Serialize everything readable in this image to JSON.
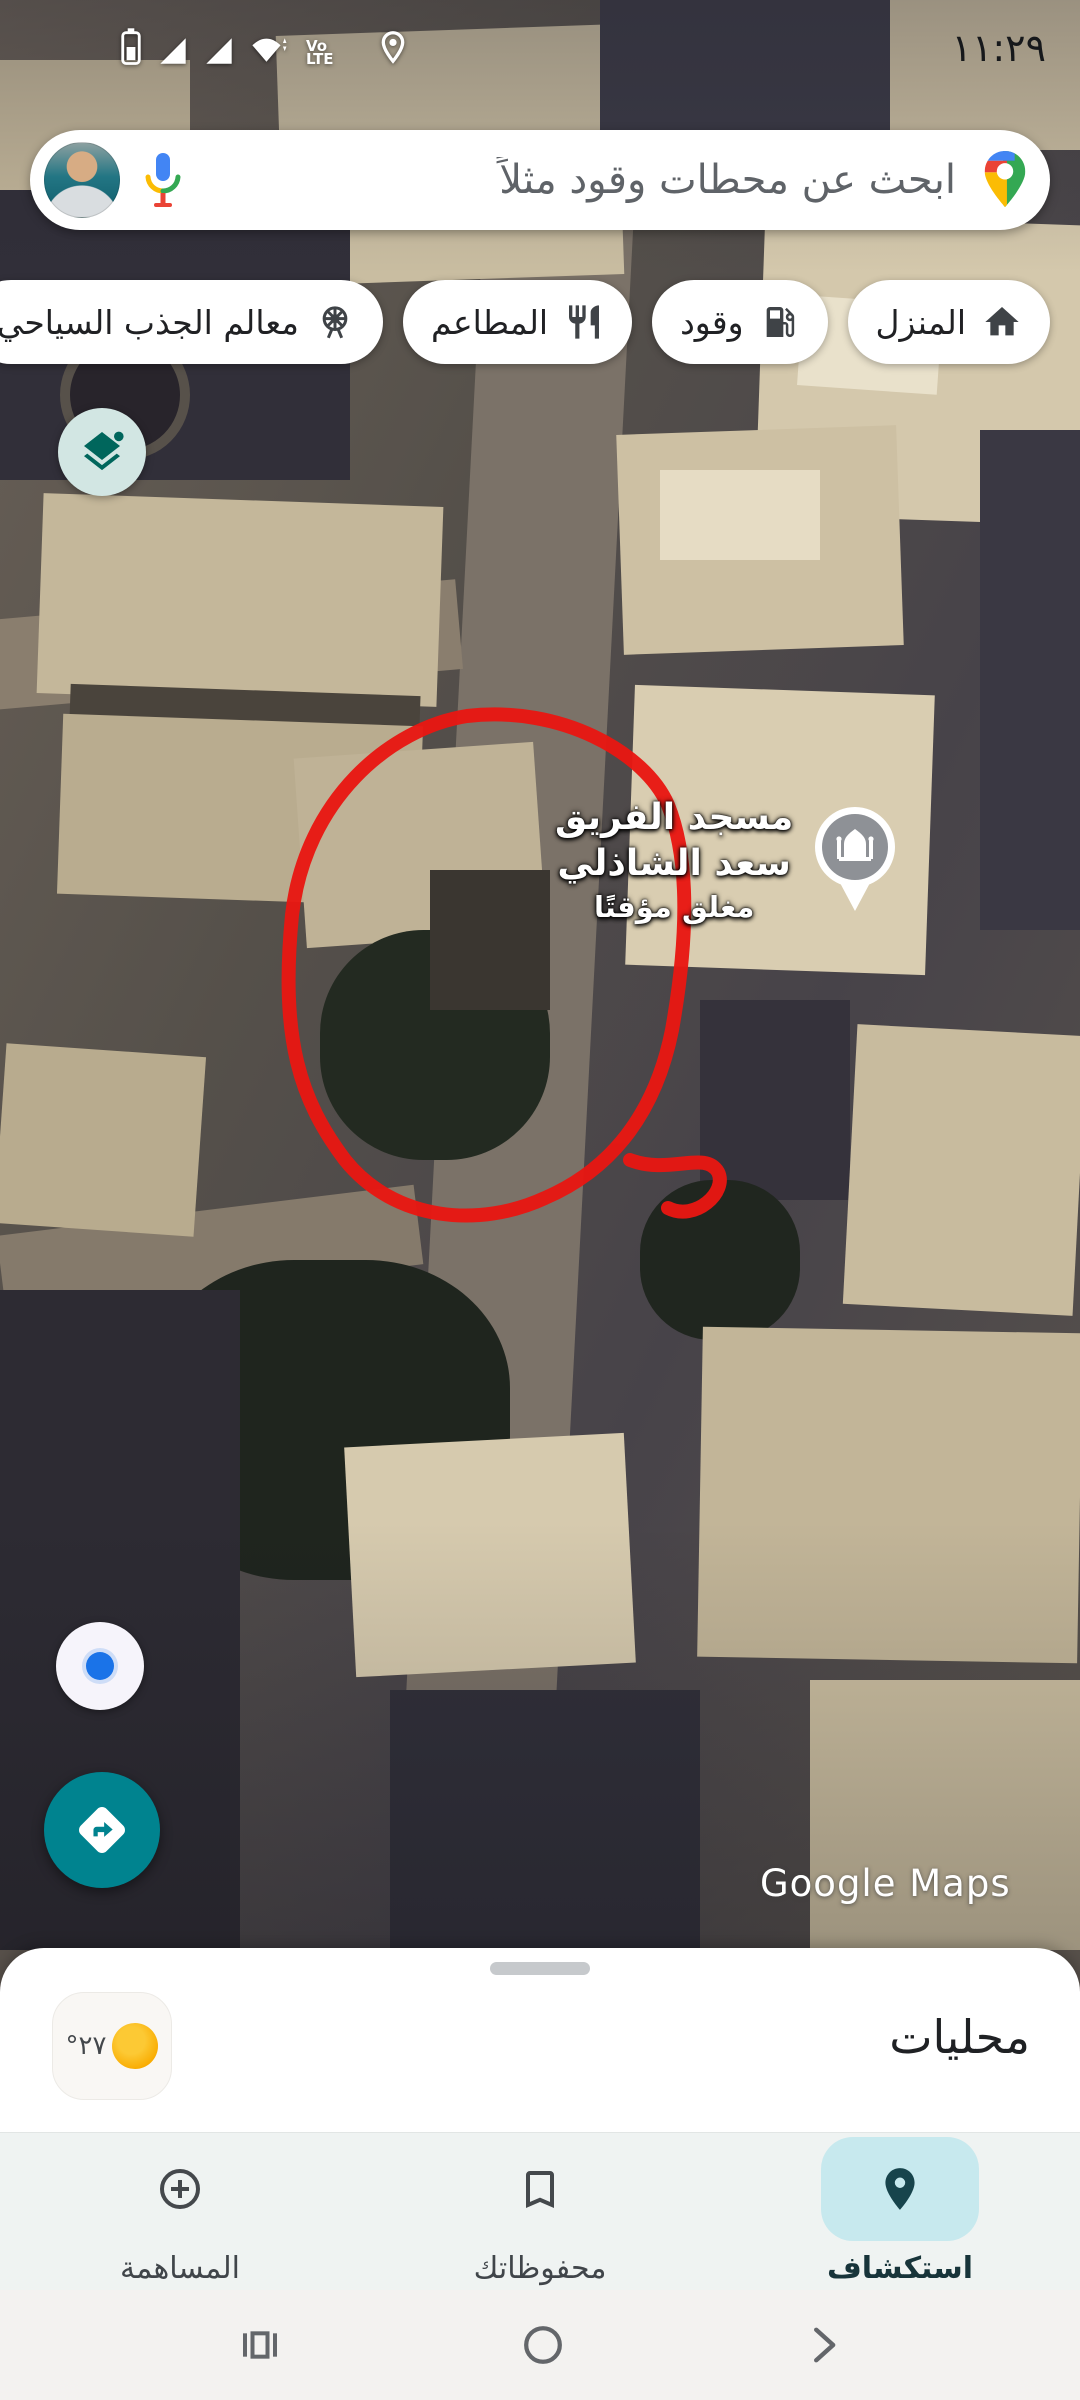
{
  "status_bar": {
    "time": "١١:٢٩",
    "volte_line1": "Vo",
    "volte_line2": "LTE",
    "icons": [
      "battery-icon",
      "signal-icon",
      "signal-icon",
      "wifi-icon",
      "volte-label",
      "location-pin-icon"
    ]
  },
  "search": {
    "placeholder": "ابحث عن محطات وقود مثلاً",
    "icons": [
      "google-maps-pin-logo",
      "mic-icon",
      "profile-avatar"
    ]
  },
  "chips": [
    {
      "label": "المنزل",
      "icon": "home-icon"
    },
    {
      "label": "وقود",
      "icon": "fuel-icon"
    },
    {
      "label": "المطاعم",
      "icon": "restaurant-icon"
    },
    {
      "label": "معالم الجذب السياحي",
      "icon": "attractions-icon"
    }
  ],
  "map": {
    "type": "satellite",
    "place_label": {
      "line1": "مسجد الفريق",
      "line2": "سعد الشاذلي",
      "status": "مغلق مؤقتًا",
      "icon": "mosque-pin-icon"
    },
    "annotation": "hand-drawn red circle",
    "watermark": "Google Maps"
  },
  "bottom_sheet": {
    "title": "محليات",
    "weather_temp": "°٢٧",
    "weather_icon": "sun-icon"
  },
  "bottom_nav": [
    {
      "label": "استكشاف",
      "icon": "explore-pin-icon",
      "active": true
    },
    {
      "label": "محفوظاتك",
      "icon": "bookmark-icon",
      "active": false
    },
    {
      "label": "المساهمة",
      "icon": "add-circle-icon",
      "active": false
    }
  ],
  "android_nav": [
    "recents-button",
    "home-button",
    "back-button"
  ],
  "colors": {
    "accent_teal": "#00838f",
    "active_pill": "#c7e9ee",
    "annotation_red": "#e81712",
    "location_blue": "#1a73e8",
    "layers_bg": "#d2e6e3"
  }
}
